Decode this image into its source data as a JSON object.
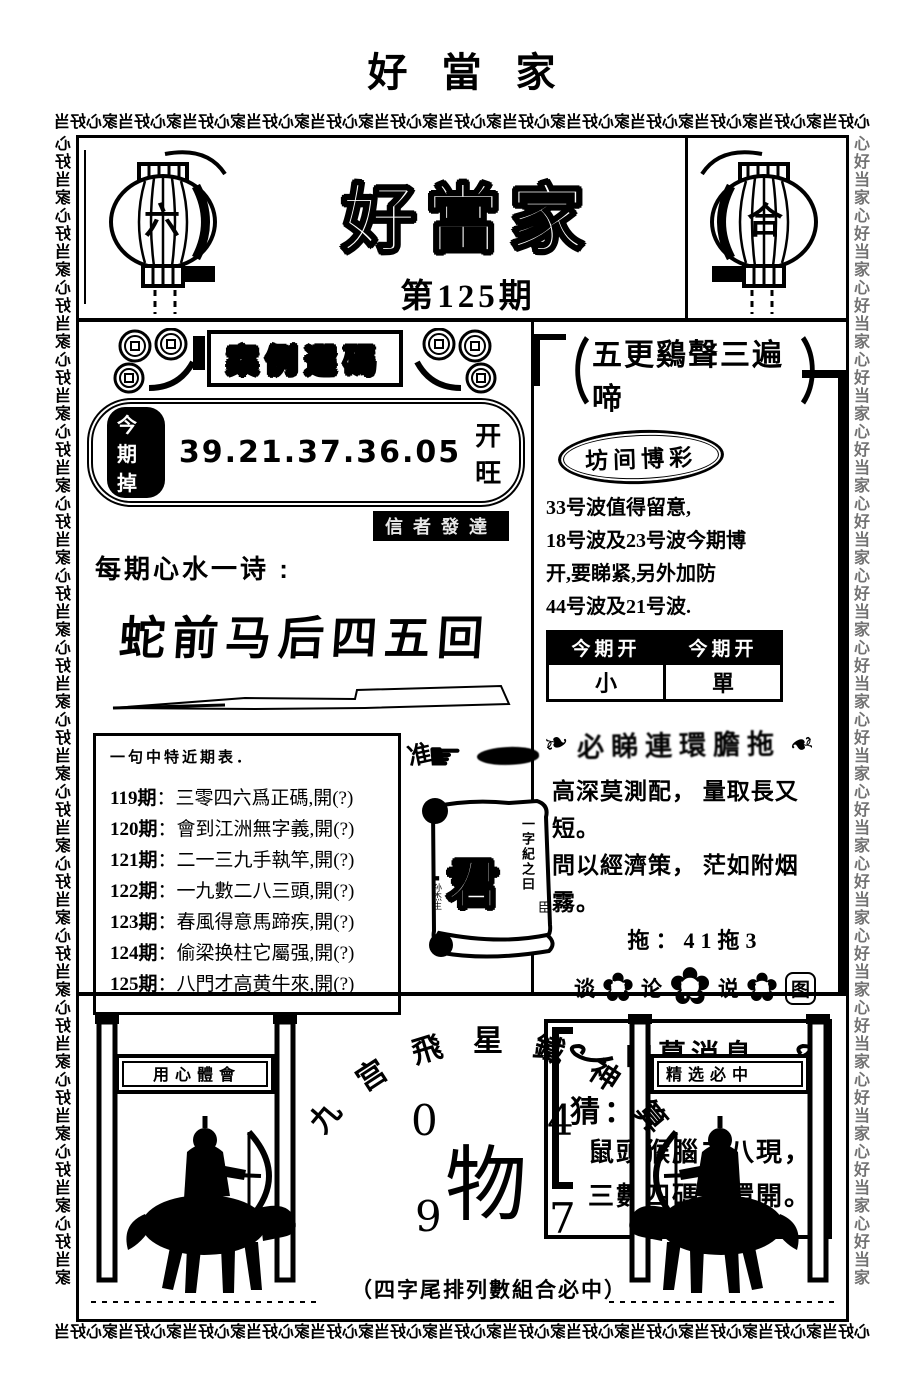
{
  "page": {
    "top_title": "好當家"
  },
  "border": {
    "pattern": "心好当家"
  },
  "banner": {
    "title": "好當家",
    "issue": "第125期",
    "left_lantern_char": "六",
    "right_lantern_char": "合"
  },
  "left_panel": {
    "header": "案例選碼",
    "pill": {
      "label": "今期掉",
      "numbers": "39.21.37.36.05",
      "suffix": "开旺"
    },
    "black_tag": "信者發達",
    "poem_label": "每期心水一诗 :",
    "poem": "蛇前马后四五回",
    "history": {
      "header": "一句中特近期表．",
      "rows": [
        {
          "issue": "119期",
          "text": "：三零四六爲正碼,開(?)"
        },
        {
          "issue": "120期",
          "text": "：會到江洲無字義,開(?)"
        },
        {
          "issue": "121期",
          "text": "：二一三九手執竿,開(?)"
        },
        {
          "issue": "122期",
          "text": "：一九數二八三頭,開(?)"
        },
        {
          "issue": "123期",
          "text": "：春風得意馬蹄疾,開(?)"
        },
        {
          "issue": "124期",
          "text": "：偷梁换柱它屬强,開(?)"
        },
        {
          "issue": "125期",
          "text": "：八門才高黄牛來,開(?)"
        }
      ]
    },
    "stamp": {
      "accurate": "准",
      "hand_icon": "☛",
      "scroll_char": "君",
      "scroll_side": "一字紀之曰",
      "scroll_side2": "臣",
      "scroll_sig": "■孙杰生"
    }
  },
  "right_panel": {
    "header": "五更鷄聲三遍啼",
    "paren_open": "（",
    "paren_close": "）",
    "oval": "坊间博彩",
    "advice_lines": [
      "33号波值得留意,",
      "18号波及23号波今期博",
      "开,要睇紧,另外加防",
      "44号波及21号波."
    ],
    "table": {
      "headers": [
        "今期开",
        "今期开"
      ],
      "values": [
        "小",
        "單"
      ]
    },
    "leaf_banner": "必睇連環膽拖",
    "poem_lines": [
      "高深莫測配， 量取長又短。",
      "問以經濟策， 茫如附烟霧。"
    ],
    "dan_tuo": "拖：41拖3",
    "flower_header": [
      "谈",
      "梅",
      "论",
      "花",
      "说",
      "秘",
      "图"
    ],
    "inside": {
      "title": "内幕消息",
      "guess": "猜：",
      "lines": [
        "鼠頭猴腦二八現，",
        "三數四碼連環開。"
      ]
    }
  },
  "bottom": {
    "arc_chars": [
      "九",
      "宫",
      "飛",
      "星",
      "鐵",
      "神",
      "算"
    ],
    "grid": {
      "top_left": "0",
      "top_right": "4",
      "center": "物",
      "bottom_left": "9",
      "bottom_right": "7"
    },
    "caption": "（四字尾排列數組合必中）",
    "left_gate": "用心體會",
    "right_gate": "精选必中"
  }
}
